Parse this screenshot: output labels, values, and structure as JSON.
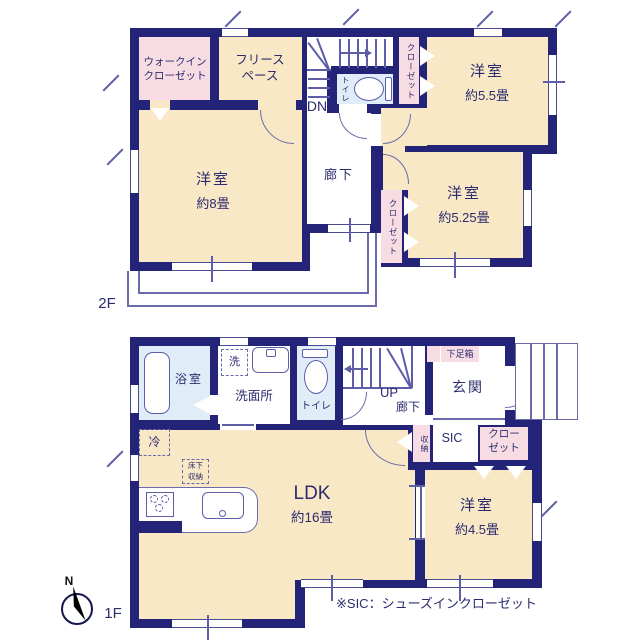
{
  "floor2": {
    "label": "2F",
    "walk_in_closet_l1": "ウォークイン",
    "walk_in_closet_l2": "クローゼット",
    "free_space_l1": "フリース",
    "free_space_l2": "ペース",
    "stairs_down": "DN",
    "toilet": "トイレ",
    "closet_north": "クローゼット",
    "bedroom_55_name": "洋室",
    "bedroom_55_size": "約5.5畳",
    "hallway": "廊下",
    "closet_mid": "クローゼット",
    "bedroom_8_name": "洋室",
    "bedroom_8_size": "約8畳",
    "bedroom_525_name": "洋室",
    "bedroom_525_size": "約5.25畳"
  },
  "floor1": {
    "label": "1F",
    "bath": "浴室",
    "washer": "洗",
    "washroom": "洗面所",
    "toilet": "トイレ",
    "stairs_up": "UP",
    "hallway": "廊下",
    "entrance": "玄関",
    "shoe_box": "下足箱",
    "storage": "収納",
    "sic": "SIC",
    "closet_l1": "クロー",
    "closet_l2": "ゼット",
    "fridge": "冷",
    "underfloor_l1": "床下",
    "underfloor_l2": "収納",
    "ldk_name": "LDK",
    "ldk_size": "約16畳",
    "bedroom_45_name": "洋室",
    "bedroom_45_size": "約4.5畳"
  },
  "compass_north": "N",
  "footnote": "※SIC：シューズインクローゼット",
  "colors": {
    "wall": "#232378",
    "room": "#f8e8c6",
    "closet": "#f8dce3",
    "wet_area": "#e0edf8",
    "fixture_line": "#6b6bab",
    "text": "#2b2b6e"
  }
}
